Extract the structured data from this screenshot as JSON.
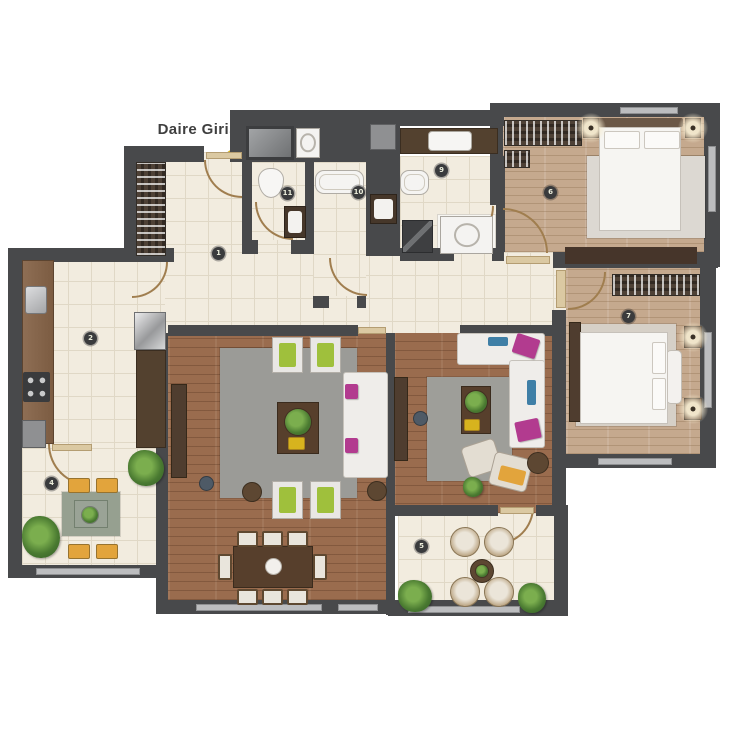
{
  "title": {
    "label": "Daire Girişi"
  },
  "colors": {
    "wall": "#48494b",
    "tile": "#f2ecdf",
    "tileLine": "#e0d8c6",
    "wood": "#9a6c4e",
    "woodLight": "#c5a98e",
    "accentGreen": "#9fc03c",
    "accentMagenta": "#b23b8f",
    "accentOrange": "#e2a43c",
    "accentGold": "#d7b31e"
  },
  "rooms": [
    {
      "n": "entry-hall",
      "f": "tile",
      "x": 162,
      "y": 152,
      "w": 146,
      "h": 110
    },
    {
      "n": "corridor",
      "f": "tile",
      "x": 162,
      "y": 252,
      "w": 406,
      "h": 81
    },
    {
      "n": "kitchen",
      "f": "tile",
      "x": 22,
      "y": 258,
      "w": 143,
      "h": 190
    },
    {
      "n": "balcony-left",
      "f": "tile",
      "x": 22,
      "y": 448,
      "w": 143,
      "h": 118
    },
    {
      "n": "salon-dining",
      "f": "wood",
      "x": 168,
      "y": 333,
      "w": 218,
      "h": 267
    },
    {
      "n": "sitting-room",
      "f": "wood",
      "x": 394,
      "y": 333,
      "w": 158,
      "h": 180
    },
    {
      "n": "bedroom-1",
      "f": "woodlight",
      "x": 503,
      "y": 117,
      "w": 201,
      "h": 135
    },
    {
      "n": "bedroom-2",
      "f": "woodlight",
      "x": 566,
      "y": 268,
      "w": 136,
      "h": 186
    },
    {
      "n": "balcony-right",
      "f": "tile",
      "x": 398,
      "y": 513,
      "w": 156,
      "h": 90
    },
    {
      "n": "bathroom-wc",
      "f": "tile",
      "x": 250,
      "y": 162,
      "w": 55,
      "h": 78
    },
    {
      "n": "bathroom-2",
      "f": "tile",
      "x": 313,
      "y": 162,
      "w": 53,
      "h": 134
    },
    {
      "n": "bathroom-3",
      "f": "tile",
      "x": 400,
      "y": 156,
      "w": 98,
      "h": 96
    },
    {
      "n": "laundry",
      "f": "white",
      "x": 437,
      "y": 214,
      "w": 59,
      "h": 38
    }
  ],
  "walls": [
    [
      128,
      146,
      76,
      16
    ],
    [
      242,
      146,
      66,
      16
    ],
    [
      124,
      146,
      12,
      116
    ],
    [
      128,
      248,
      46,
      14
    ],
    [
      8,
      248,
      122,
      14
    ],
    [
      8,
      248,
      14,
      330
    ],
    [
      8,
      565,
      160,
      13
    ],
    [
      156,
      333,
      12,
      267
    ],
    [
      156,
      600,
      412,
      14
    ],
    [
      230,
      110,
      274,
      16
    ],
    [
      230,
      124,
      76,
      38
    ],
    [
      306,
      124,
      62,
      38
    ],
    [
      366,
      116,
      34,
      84
    ],
    [
      366,
      196,
      34,
      60
    ],
    [
      242,
      158,
      10,
      96
    ],
    [
      305,
      162,
      9,
      92
    ],
    [
      248,
      240,
      10,
      14
    ],
    [
      291,
      240,
      22,
      14
    ],
    [
      313,
      296,
      16,
      12
    ],
    [
      357,
      296,
      9,
      12
    ],
    [
      400,
      248,
      54,
      13
    ],
    [
      492,
      248,
      12,
      13
    ],
    [
      496,
      156,
      9,
      96
    ],
    [
      490,
      103,
      230,
      14
    ],
    [
      490,
      103,
      13,
      102
    ],
    [
      704,
      103,
      16,
      164
    ],
    [
      553,
      252,
      165,
      16
    ],
    [
      700,
      268,
      16,
      200
    ],
    [
      556,
      454,
      148,
      14
    ],
    [
      552,
      310,
      14,
      205
    ],
    [
      168,
      325,
      190,
      11
    ],
    [
      460,
      325,
      94,
      11
    ],
    [
      386,
      333,
      9,
      182
    ],
    [
      394,
      505,
      104,
      11
    ],
    [
      536,
      505,
      18,
      11
    ],
    [
      386,
      513,
      9,
      102
    ],
    [
      554,
      505,
      14,
      111
    ],
    [
      388,
      603,
      180,
      13
    ]
  ],
  "windows": [
    [
      708,
      146,
      8,
      66
    ],
    [
      620,
      107,
      58,
      7
    ],
    [
      704,
      332,
      8,
      76
    ],
    [
      598,
      458,
      74,
      7
    ],
    [
      196,
      604,
      126,
      7
    ],
    [
      338,
      604,
      40,
      7
    ],
    [
      408,
      606,
      112,
      7
    ],
    [
      36,
      568,
      104,
      7
    ]
  ],
  "doors": [
    {
      "x": 204,
      "y": 160,
      "s": 38,
      "q": "bl",
      "n": "entrance-door"
    },
    {
      "x": 132,
      "y": 262,
      "s": 36,
      "q": "br",
      "n": "kitchen-door"
    },
    {
      "x": 255,
      "y": 202,
      "s": 38,
      "q": "bl",
      "n": "wc-door"
    },
    {
      "x": 329,
      "y": 258,
      "s": 38,
      "q": "bl",
      "n": "bathroom-2-door"
    },
    {
      "x": 452,
      "y": 206,
      "s": 42,
      "q": "br",
      "n": "bathroom-3-door"
    },
    {
      "x": 503,
      "y": 208,
      "s": 45,
      "q": "tr",
      "n": "bedroom-1-door"
    },
    {
      "x": 568,
      "y": 272,
      "s": 38,
      "q": "br",
      "n": "bedroom-2-door"
    },
    {
      "x": 48,
      "y": 444,
      "s": 42,
      "q": "bl",
      "n": "balcony-left-door"
    },
    {
      "x": 496,
      "y": 507,
      "s": 38,
      "q": "br",
      "n": "balcony-right-door"
    }
  ],
  "furniture": [
    {
      "t": "wardrobe-v",
      "n": "entry-wardrobe",
      "x": 136,
      "y": 162,
      "w": 30,
      "h": 94
    },
    {
      "t": "shower",
      "n": "shower-stall",
      "x": 246,
      "y": 126,
      "w": 48,
      "h": 34
    },
    {
      "t": "washer",
      "n": "washer-cabinet",
      "x": 296,
      "y": 128,
      "w": 24,
      "h": 30
    },
    {
      "t": "oven",
      "n": "shaft-unit",
      "x": 370,
      "y": 124,
      "w": 26,
      "h": 26
    },
    {
      "t": "counter-d",
      "n": "bathroom-3-counter",
      "x": 400,
      "y": 128,
      "w": 98,
      "h": 26
    },
    {
      "t": "sink-w",
      "n": "bathroom-3-sink",
      "x": 428,
      "y": 131,
      "w": 44,
      "h": 20
    },
    {
      "t": "toilet",
      "n": "wc-toilet",
      "x": 258,
      "y": 168,
      "w": 26,
      "h": 30
    },
    {
      "t": "vanity",
      "n": "wc-vanity",
      "x": 284,
      "y": 206,
      "w": 22,
      "h": 32
    },
    {
      "t": "tub",
      "n": "bathroom-2-tub",
      "x": 315,
      "y": 170,
      "w": 49,
      "h": 24
    },
    {
      "t": "vanity",
      "n": "shaft-sink",
      "x": 370,
      "y": 194,
      "w": 27,
      "h": 30
    },
    {
      "t": "tub",
      "n": "bathroom-3-tub",
      "x": 400,
      "y": 170,
      "w": 29,
      "h": 25
    },
    {
      "t": "shower-d",
      "n": "bathroom-3-shower",
      "x": 402,
      "y": 220,
      "w": 31,
      "h": 33
    },
    {
      "t": "washer",
      "n": "laundry-washer",
      "x": 440,
      "y": 216,
      "w": 53,
      "h": 38
    },
    {
      "t": "counter-b",
      "n": "kitchen-counter",
      "x": 22,
      "y": 260,
      "w": 32,
      "h": 184
    },
    {
      "t": "sink-k",
      "n": "kitchen-sink",
      "x": 25,
      "y": 286,
      "w": 22,
      "h": 28
    },
    {
      "t": "stove",
      "n": "kitchen-stove",
      "x": 23,
      "y": 372,
      "w": 27,
      "h": 30
    },
    {
      "t": "oven",
      "n": "kitchen-oven",
      "x": 22,
      "y": 420,
      "w": 24,
      "h": 28
    },
    {
      "t": "fridge",
      "n": "kitchen-fridge",
      "x": 134,
      "y": 312,
      "w": 32,
      "h": 38
    },
    {
      "t": "counter-d",
      "n": "kitchen-counter-2",
      "x": 136,
      "y": 350,
      "w": 30,
      "h": 98
    },
    {
      "t": "rug",
      "n": "salon-rug",
      "x": 220,
      "y": 348,
      "w": 137,
      "h": 150,
      "bg": "#9b9b97"
    },
    {
      "t": "rug",
      "n": "sitting-rug",
      "x": 427,
      "y": 377,
      "w": 85,
      "h": 104,
      "bg": "#9e9e99"
    },
    {
      "t": "rug",
      "n": "bedroom-1-rug",
      "x": 587,
      "y": 156,
      "w": 118,
      "h": 82,
      "bg": "#dcd8d2"
    },
    {
      "t": "rug",
      "n": "bedroom-2-rug",
      "x": 576,
      "y": 324,
      "w": 100,
      "h": 102,
      "bg": "#d6d0c7"
    },
    {
      "t": "rug",
      "n": "balcony-left-rug",
      "x": 62,
      "y": 492,
      "w": 58,
      "h": 44,
      "bg": "#96a090"
    },
    {
      "t": "tv",
      "n": "salon-tv-unit",
      "x": 171,
      "y": 384,
      "w": 16,
      "h": 94
    },
    {
      "t": "tbl",
      "n": "salon-coffee-table",
      "x": 277,
      "y": 402,
      "w": 42,
      "h": 52
    },
    {
      "t": "plantpot",
      "n": "salon-table-plant",
      "x": 285,
      "y": 409,
      "w": 26,
      "h": 26
    },
    {
      "t": "tray",
      "n": "salon-tray",
      "x": 288,
      "y": 437,
      "w": 17,
      "h": 13
    },
    {
      "t": "chair-g",
      "n": "salon-armchair",
      "x": 272,
      "y": 337,
      "w": 31,
      "h": 36
    },
    {
      "t": "chair-g",
      "n": "salon-armchair",
      "x": 310,
      "y": 337,
      "w": 31,
      "h": 36
    },
    {
      "t": "chair-g",
      "n": "salon-armchair",
      "x": 272,
      "y": 481,
      "w": 31,
      "h": 38
    },
    {
      "t": "chair-g",
      "n": "salon-armchair",
      "x": 310,
      "y": 481,
      "w": 31,
      "h": 38
    },
    {
      "t": "sofa",
      "n": "salon-sofa",
      "x": 343,
      "y": 372,
      "w": 45,
      "h": 106
    },
    {
      "t": "pillow-m",
      "n": "sofa-pillow",
      "x": 345,
      "y": 384,
      "w": 13,
      "h": 15
    },
    {
      "t": "pillow-m",
      "n": "sofa-pillow",
      "x": 345,
      "y": 438,
      "w": 13,
      "h": 15
    },
    {
      "t": "round-blue",
      "n": "salon-side-stool",
      "x": 199,
      "y": 476,
      "w": 15,
      "h": 15
    },
    {
      "t": "round-dark",
      "n": "salon-side-table",
      "x": 242,
      "y": 482,
      "w": 20,
      "h": 20
    },
    {
      "t": "round-dark",
      "n": "salon-side-table",
      "x": 367,
      "y": 481,
      "w": 20,
      "h": 20
    },
    {
      "t": "tv",
      "n": "sitting-tv-unit",
      "x": 394,
      "y": 377,
      "w": 14,
      "h": 84
    },
    {
      "t": "sofa",
      "n": "sitting-sofa-top",
      "x": 457,
      "y": 333,
      "w": 88,
      "h": 32
    },
    {
      "t": "sofa",
      "n": "sitting-sofa-right",
      "x": 509,
      "y": 360,
      "w": 36,
      "h": 88
    },
    {
      "t": "pillow-m",
      "n": "sofa-pillow",
      "x": 514,
      "y": 336,
      "w": 24,
      "h": 20,
      "r": 18
    },
    {
      "t": "pillow-m",
      "n": "sofa-pillow",
      "x": 516,
      "y": 420,
      "w": 24,
      "h": 20,
      "r": -12
    },
    {
      "t": "pillow-b",
      "n": "sofa-pillow",
      "x": 488,
      "y": 337,
      "w": 20,
      "h": 9
    },
    {
      "t": "pillow-b",
      "n": "sofa-pillow",
      "x": 527,
      "y": 380,
      "w": 9,
      "h": 25
    },
    {
      "t": "tbl",
      "n": "sitting-coffee-table",
      "x": 461,
      "y": 386,
      "w": 30,
      "h": 48
    },
    {
      "t": "plantpot",
      "n": "sitting-table-plant",
      "x": 465,
      "y": 391,
      "w": 22,
      "h": 22
    },
    {
      "t": "tray",
      "n": "sitting-tray",
      "x": 464,
      "y": 419,
      "w": 16,
      "h": 12
    },
    {
      "t": "chair-beige",
      "n": "sitting-armchair",
      "x": 464,
      "y": 442,
      "w": 35,
      "h": 32,
      "r": -18
    },
    {
      "t": "chair-beige",
      "n": "sitting-armchair",
      "x": 491,
      "y": 455,
      "w": 39,
      "h": 34,
      "r": 14
    },
    {
      "t": "blanket",
      "n": "armchair-blanket",
      "x": 499,
      "y": 468,
      "w": 26,
      "h": 15,
      "r": 14
    },
    {
      "t": "round-dark",
      "n": "sitting-basket-table",
      "x": 527,
      "y": 452,
      "w": 22,
      "h": 22
    },
    {
      "t": "plant",
      "n": "sitting-plant",
      "x": 463,
      "y": 477,
      "w": 20,
      "h": 20
    },
    {
      "t": "round-blue",
      "n": "sitting-side-stool",
      "x": 413,
      "y": 411,
      "w": 15,
      "h": 15
    },
    {
      "t": "tbl",
      "n": "dining-table",
      "x": 233,
      "y": 546,
      "w": 80,
      "h": 42
    },
    {
      "t": "center-p",
      "n": "dining-centerpiece",
      "x": 265,
      "y": 558,
      "w": 17,
      "h": 17
    },
    {
      "t": "chair-d",
      "n": "dining-chair",
      "x": 237,
      "y": 531,
      "w": 21,
      "h": 16
    },
    {
      "t": "chair-d",
      "n": "dining-chair",
      "x": 262,
      "y": 531,
      "w": 21,
      "h": 16
    },
    {
      "t": "chair-d",
      "n": "dining-chair",
      "x": 287,
      "y": 531,
      "w": 21,
      "h": 16
    },
    {
      "t": "chair-d",
      "n": "dining-chair",
      "x": 237,
      "y": 589,
      "w": 21,
      "h": 16
    },
    {
      "t": "chair-d",
      "n": "dining-chair",
      "x": 262,
      "y": 589,
      "w": 21,
      "h": 16
    },
    {
      "t": "chair-d",
      "n": "dining-chair",
      "x": 287,
      "y": 589,
      "w": 21,
      "h": 16
    },
    {
      "t": "chair-d",
      "n": "dining-chair",
      "x": 218,
      "y": 554,
      "w": 14,
      "h": 26
    },
    {
      "t": "chair-d",
      "n": "dining-chair",
      "x": 313,
      "y": 554,
      "w": 14,
      "h": 26
    },
    {
      "t": "wardrobe-h",
      "n": "bedroom-1-wardrobe",
      "x": 504,
      "y": 120,
      "w": 78,
      "h": 26
    },
    {
      "t": "wardrobe-h",
      "n": "bedroom-1-cabinet",
      "x": 504,
      "y": 150,
      "w": 26,
      "h": 18
    },
    {
      "t": "headboard",
      "n": "bedroom-1-headboard",
      "x": 597,
      "y": 118,
      "w": 86,
      "h": 9
    },
    {
      "t": "bed-body",
      "n": "bedroom-1-bed",
      "x": 599,
      "y": 127,
      "w": 82,
      "h": 104
    },
    {
      "t": "pillow-w",
      "n": "bed-pillow",
      "x": 604,
      "y": 131,
      "w": 36,
      "h": 18
    },
    {
      "t": "pillow-w",
      "n": "bed-pillow",
      "x": 644,
      "y": 131,
      "w": 36,
      "h": 18
    },
    {
      "t": "bedside",
      "n": "bedroom-1-nightstand",
      "x": 583,
      "y": 118,
      "w": 16,
      "h": 20
    },
    {
      "t": "bedside",
      "n": "bedroom-1-nightstand",
      "x": 685,
      "y": 118,
      "w": 16,
      "h": 20
    },
    {
      "t": "bench",
      "n": "bedroom-1-dresser",
      "x": 565,
      "y": 247,
      "w": 132,
      "h": 17
    },
    {
      "t": "wardrobe-h",
      "n": "bedroom-2-wardrobe",
      "x": 612,
      "y": 274,
      "w": 88,
      "h": 22
    },
    {
      "t": "tv",
      "n": "bedroom-2-dresser",
      "x": 569,
      "y": 322,
      "w": 12,
      "h": 100
    },
    {
      "t": "headboard-w",
      "n": "bedroom-2-headboard",
      "x": 666,
      "y": 350,
      "w": 16,
      "h": 54
    },
    {
      "t": "bed-body",
      "n": "bedroom-2-bed",
      "x": 580,
      "y": 332,
      "w": 88,
      "h": 92
    },
    {
      "t": "pillow-w",
      "n": "bed-pillow",
      "x": 652,
      "y": 342,
      "w": 14,
      "h": 32
    },
    {
      "t": "pillow-w",
      "n": "bed-pillow",
      "x": 652,
      "y": 378,
      "w": 14,
      "h": 32
    },
    {
      "t": "bedside",
      "n": "bedroom-2-nightstand",
      "x": 684,
      "y": 326,
      "w": 18,
      "h": 22
    },
    {
      "t": "bedside",
      "n": "bedroom-2-nightstand",
      "x": 684,
      "y": 398,
      "w": 18,
      "h": 22
    },
    {
      "t": "wicker",
      "n": "balcony-wicker-chair",
      "x": 450,
      "y": 527,
      "w": 30,
      "h": 30,
      "r": -10
    },
    {
      "t": "wicker",
      "n": "balcony-wicker-chair",
      "x": 484,
      "y": 527,
      "w": 30,
      "h": 30,
      "r": 12
    },
    {
      "t": "wicker",
      "n": "balcony-wicker-chair",
      "x": 450,
      "y": 577,
      "w": 30,
      "h": 30,
      "r": 8
    },
    {
      "t": "wicker",
      "n": "balcony-wicker-chair",
      "x": 484,
      "y": 577,
      "w": 30,
      "h": 30,
      "r": -14
    },
    {
      "t": "round-dark",
      "n": "balcony-table",
      "x": 470,
      "y": 559,
      "w": 24,
      "h": 24
    },
    {
      "t": "plantpot",
      "n": "balcony-table-plant",
      "x": 476,
      "y": 565,
      "w": 12,
      "h": 12
    },
    {
      "t": "plant",
      "n": "balcony-plant",
      "x": 398,
      "y": 580,
      "w": 34,
      "h": 32
    },
    {
      "t": "plant",
      "n": "balcony-plant",
      "x": 518,
      "y": 583,
      "w": 28,
      "h": 30
    },
    {
      "t": "plant",
      "n": "balcony-left-plant",
      "x": 128,
      "y": 450,
      "w": 36,
      "h": 36
    },
    {
      "t": "plant",
      "n": "balcony-left-plant",
      "x": 22,
      "y": 516,
      "w": 38,
      "h": 42
    },
    {
      "t": "table-balc",
      "n": "balcony-left-table",
      "x": 74,
      "y": 500,
      "w": 34,
      "h": 28
    },
    {
      "t": "plantpot",
      "n": "balcony-left-pot",
      "x": 82,
      "y": 507,
      "w": 16,
      "h": 16
    },
    {
      "t": "chair-o",
      "n": "balcony-left-chair",
      "x": 68,
      "y": 478,
      "w": 22,
      "h": 15
    },
    {
      "t": "chair-o",
      "n": "balcony-left-chair",
      "x": 96,
      "y": 478,
      "w": 22,
      "h": 15
    },
    {
      "t": "chair-o",
      "n": "balcony-left-chair",
      "x": 68,
      "y": 544,
      "w": 22,
      "h": 15
    },
    {
      "t": "chair-o",
      "n": "balcony-left-chair",
      "x": 96,
      "y": 544,
      "w": 22,
      "h": 15
    },
    {
      "t": "sill",
      "n": "entrance-sill",
      "x": 206,
      "y": 152,
      "w": 36,
      "h": 7
    },
    {
      "t": "sill",
      "n": "balcony-left-sill",
      "x": 52,
      "y": 444,
      "w": 40,
      "h": 7
    },
    {
      "t": "sill",
      "n": "balcony-right-sill",
      "x": 500,
      "y": 507,
      "w": 34,
      "h": 7
    },
    {
      "t": "sill",
      "n": "salon-opening-sill",
      "x": 358,
      "y": 327,
      "w": 28,
      "h": 7
    },
    {
      "t": "sill",
      "n": "bedroom-1-door-sill",
      "x": 506,
      "y": 256,
      "w": 44,
      "h": 8
    },
    {
      "t": "sill",
      "n": "bedroom-2-door-sill",
      "x": 556,
      "y": 270,
      "w": 10,
      "h": 38
    }
  ],
  "badges": [
    {
      "num": "1",
      "x": 218,
      "y": 253,
      "room": "hall"
    },
    {
      "num": "2",
      "x": 90,
      "y": 338,
      "room": "kitchen"
    },
    {
      "num": "11",
      "x": 287,
      "y": 193,
      "room": "wc"
    },
    {
      "num": "10",
      "x": 358,
      "y": 192,
      "room": "bathroom"
    },
    {
      "num": "9",
      "x": 441,
      "y": 170,
      "room": "bathroom"
    },
    {
      "num": "6",
      "x": 550,
      "y": 192,
      "room": "bedroom-1"
    },
    {
      "num": "7",
      "x": 628,
      "y": 316,
      "room": "bedroom-2"
    },
    {
      "num": "4",
      "x": 51,
      "y": 483,
      "room": "balcony-left"
    },
    {
      "num": "5",
      "x": 421,
      "y": 546,
      "room": "balcony-right"
    }
  ]
}
